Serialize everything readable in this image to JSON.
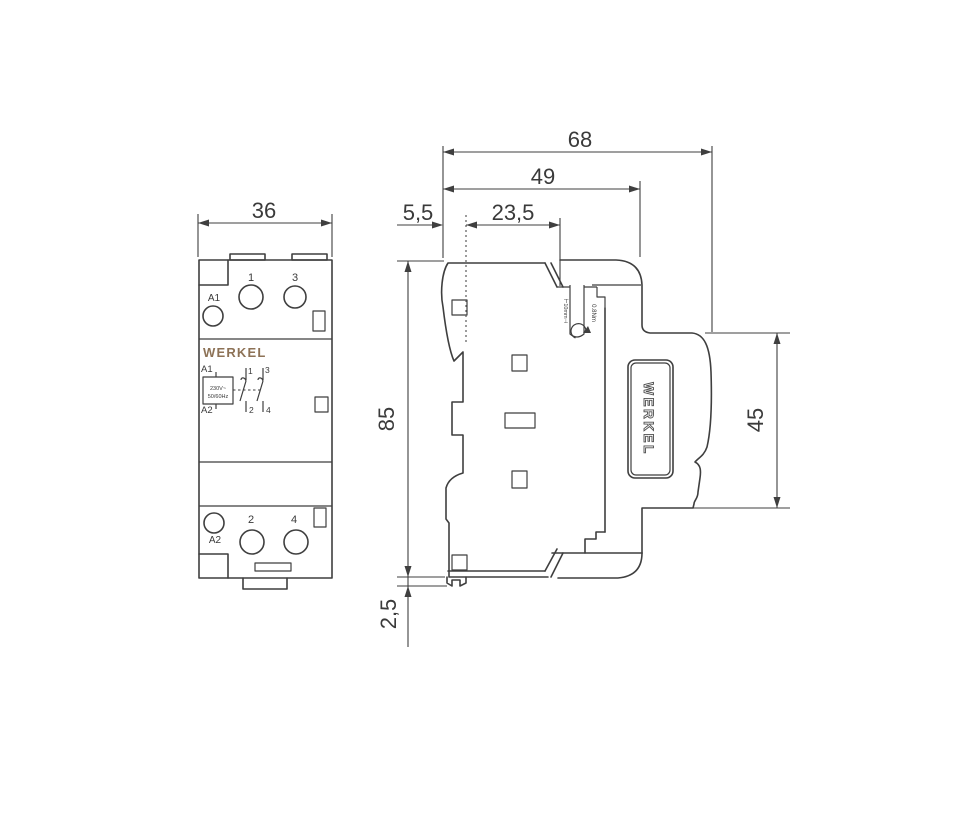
{
  "brand": {
    "name": "WERKEL",
    "logo_color": "#8d7256"
  },
  "front_view": {
    "dim_width": "36",
    "logo": "WERKEL",
    "top_terminals": {
      "a1": "A1",
      "t1": "1",
      "t3": "3"
    },
    "bottom_terminals": {
      "a2": "A2",
      "t2": "2",
      "t4": "4"
    },
    "schematic": {
      "a1": "A1",
      "a2": "A2",
      "voltage": "230V~",
      "frequency": "50/60Hz",
      "c1": "1",
      "c2": "2",
      "c3": "3",
      "c4": "4"
    }
  },
  "side_view": {
    "dim_total_depth": "68",
    "dim_body_depth": "49",
    "dim_top_inset": "23,5",
    "dim_back_inset": "5,5",
    "dim_height": "85",
    "dim_rail_clip": "2,5",
    "dim_face_height": "45",
    "strip_length_label": "⊢10mm⊣",
    "torque_label": "0.8Nm",
    "logo": "WERKEL"
  }
}
